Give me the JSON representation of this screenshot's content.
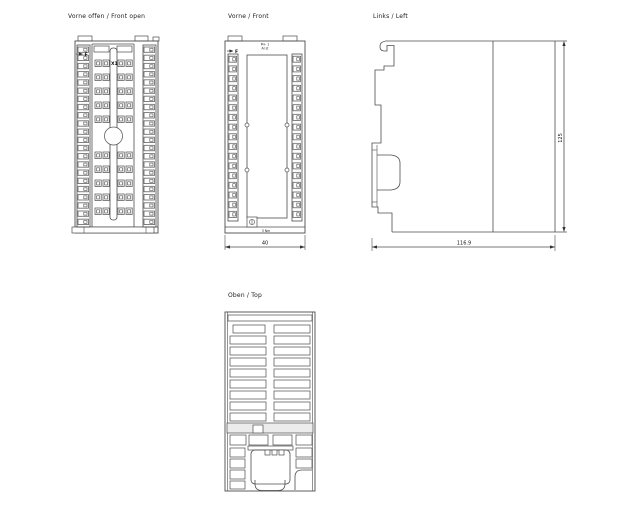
{
  "canvas": {
    "background": "#ffffff",
    "line_color": "#4c4c4c"
  },
  "views": {
    "front_open": {
      "title": "Vorne offen / Front open",
      "marker_label": "F",
      "connector_label": "X1"
    },
    "front": {
      "title": "Vorne / Front",
      "marker_label": "F",
      "print_line1": "M+ 1",
      "print_line2": "AI st",
      "screw_note": "3 Nm",
      "width_dim": "40"
    },
    "left": {
      "title": "Links / Left",
      "height_dim": "125",
      "depth_dim": "116.9"
    },
    "top": {
      "title": "Oben / Top"
    }
  }
}
